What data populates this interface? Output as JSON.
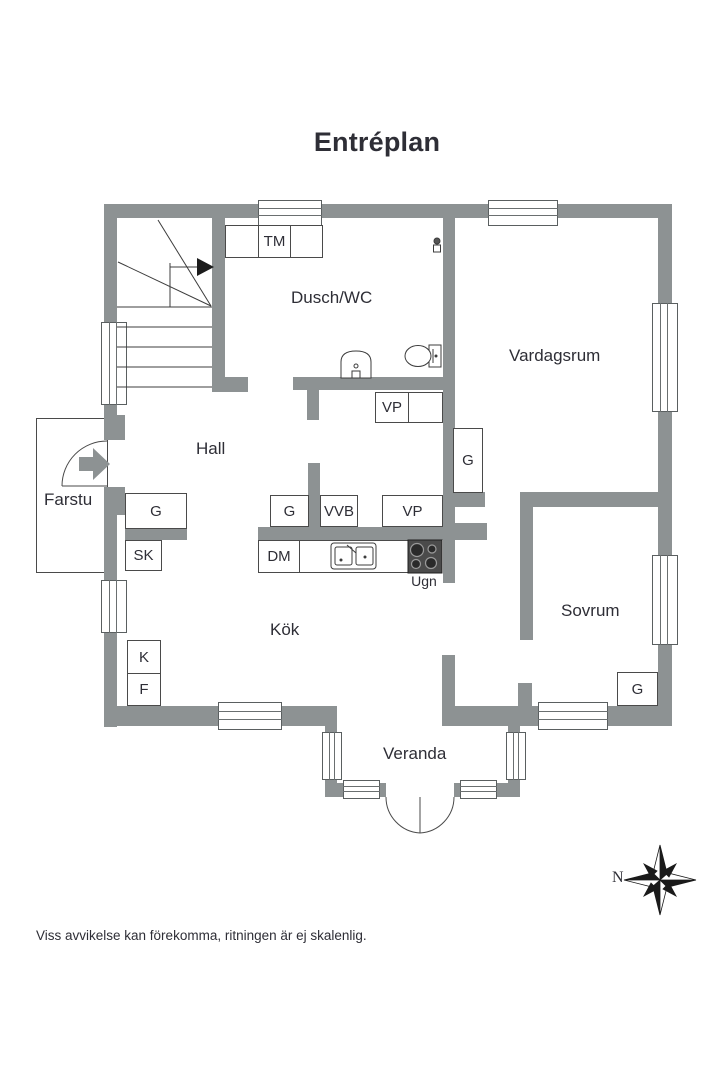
{
  "title": "Entréplan",
  "rooms": {
    "dusch_wc": "Dusch/WC",
    "vardagsrum": "Vardagsrum",
    "hall": "Hall",
    "farstu": "Farstu",
    "kok": "Kök",
    "sovrum": "Sovrum",
    "veranda": "Veranda"
  },
  "labels": {
    "tm": "TM",
    "vp_dusch": "VP",
    "g_hall": "G",
    "sk": "SK",
    "g_passage": "G",
    "vvb": "VVB",
    "vp_passage": "VP",
    "g_vardagsrum": "G",
    "dm": "DM",
    "ugn": "Ugn",
    "k": "K",
    "f": "F",
    "g_sovrum": "G"
  },
  "compass": {
    "north": "N"
  },
  "footer": "Viss avvikelse kan förekomma, ritningen är ej skalenlig.",
  "colors": {
    "wall": "#8d9293",
    "line": "#3c3c3c",
    "text": "#2e2e36",
    "stove": "#4b4b4b"
  }
}
